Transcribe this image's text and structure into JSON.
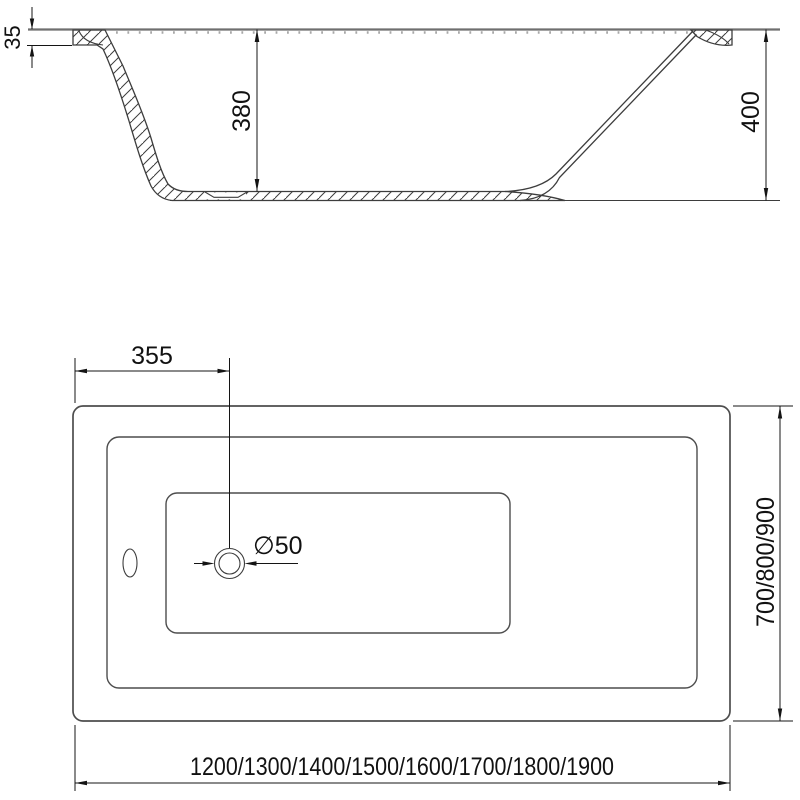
{
  "drawing": {
    "subject": "bathtub-technical-drawing",
    "colors": {
      "outline": "#3d3d3d",
      "secondary_outline": "#6f6f6f",
      "dimension": "#141414",
      "background": "#ffffff"
    },
    "views": {
      "side_section": {
        "labels": {
          "rim_thickness": "35",
          "inner_depth": "380",
          "overall_height": "400"
        }
      },
      "top_plan": {
        "labels": {
          "drain_offset_from_left": "355",
          "drain_diameter": "∅50",
          "width_options": "700/800/900",
          "length_options": "1200/1300/1400/1500/1600/1700/1800/1900"
        }
      }
    }
  }
}
